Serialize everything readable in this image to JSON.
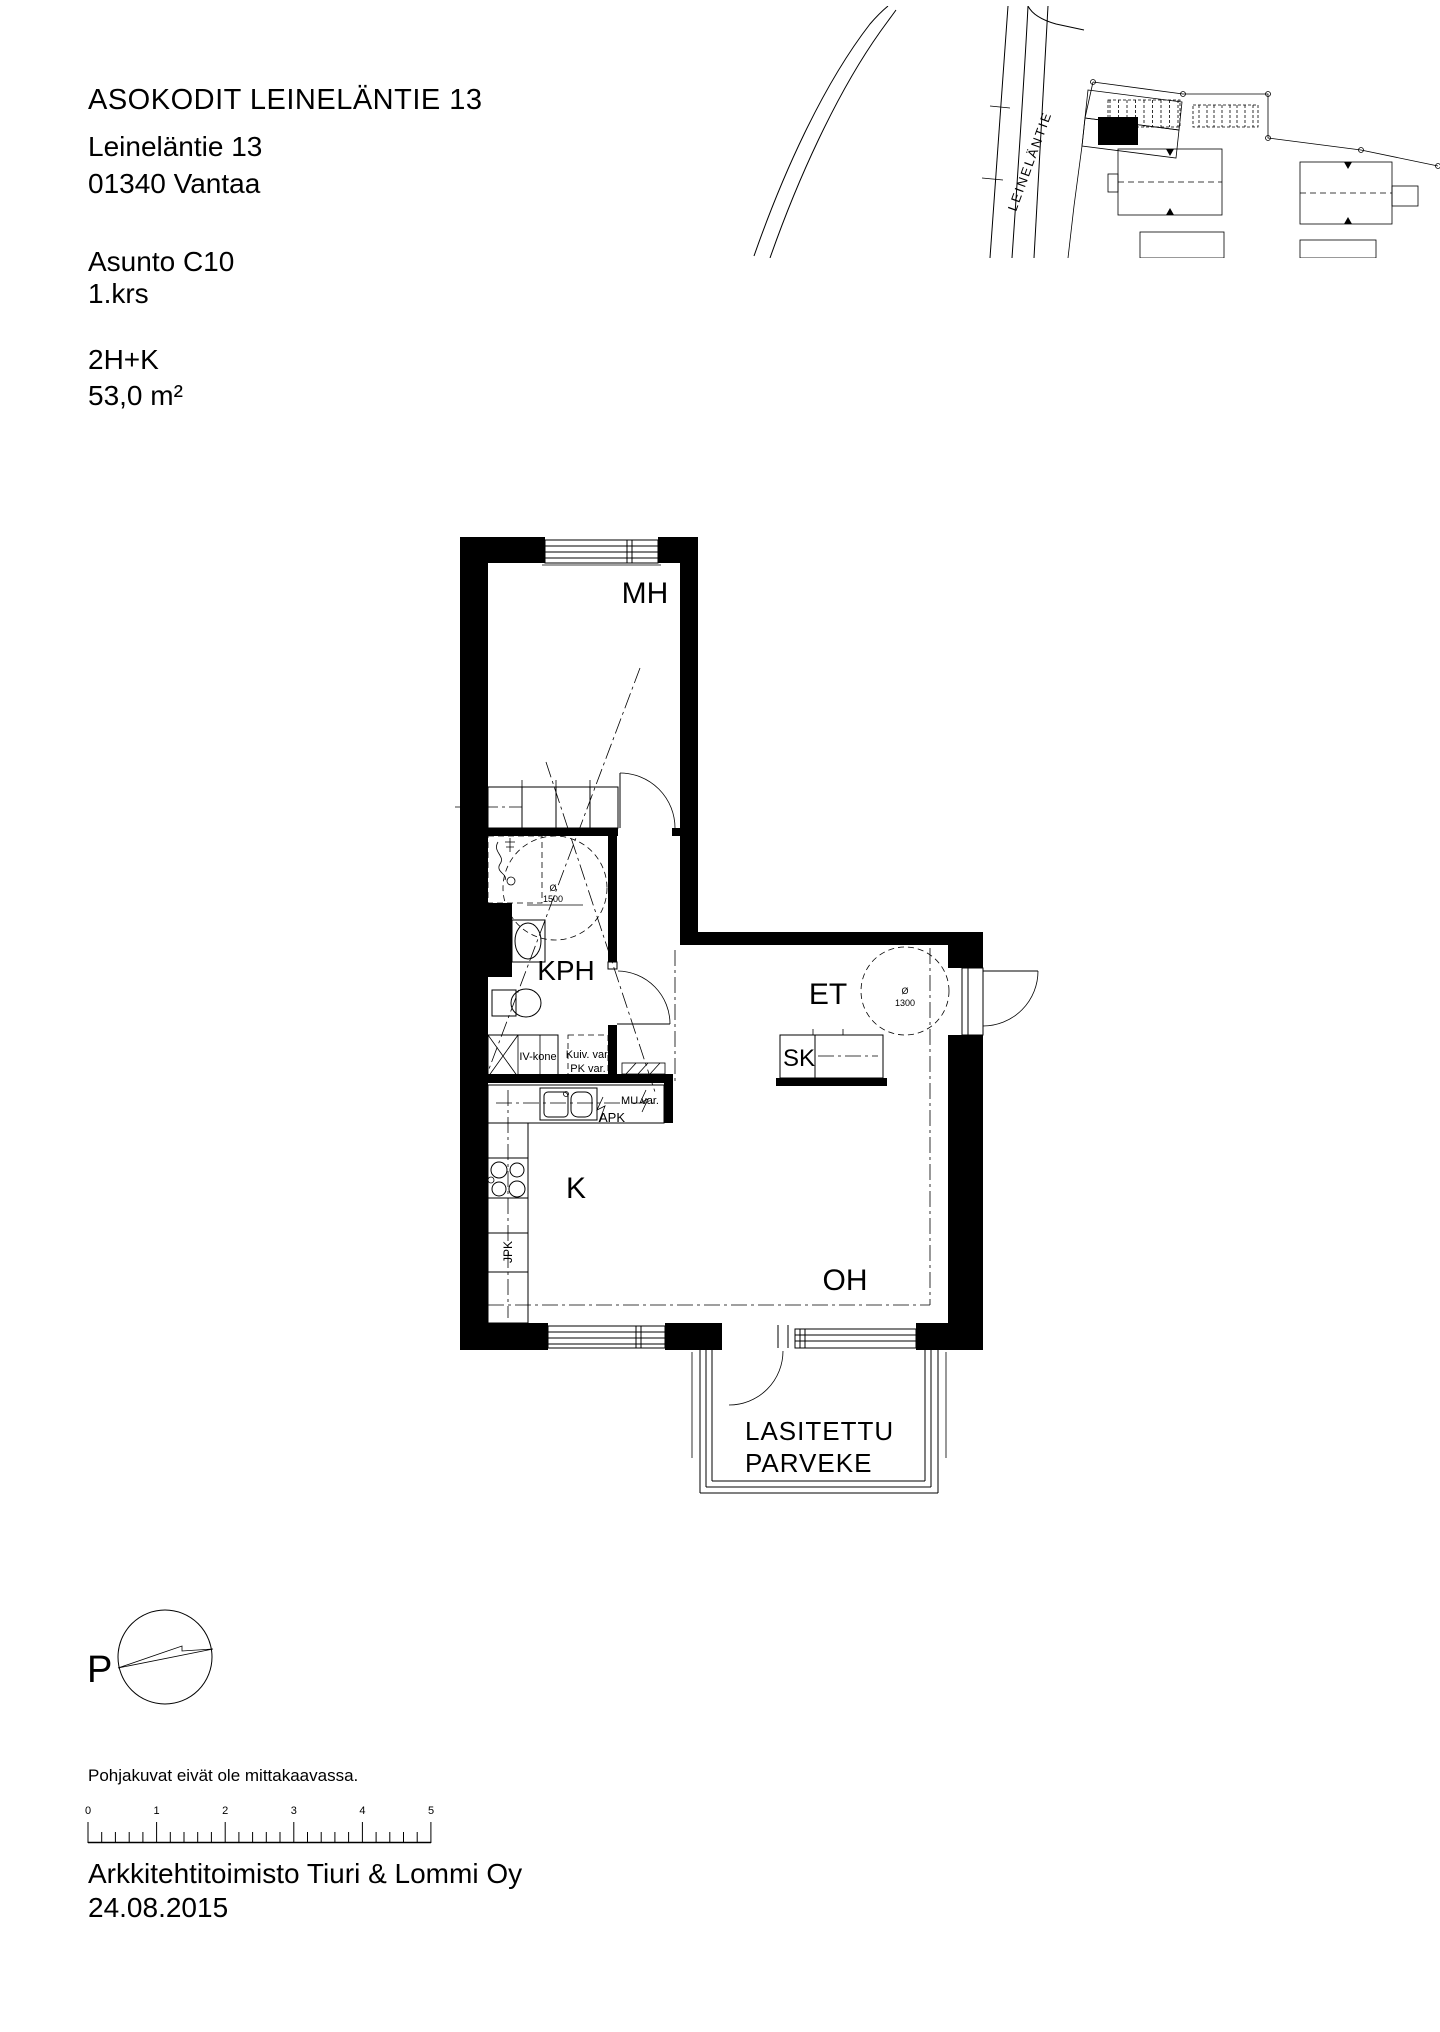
{
  "header": {
    "project": "ASOKODIT LEINELÄNTIE 13",
    "street": "Leineläntie 13",
    "city": "01340 Vantaa",
    "apartment": "Asunto C10",
    "floor": "1.krs",
    "type": "2H+K",
    "area": "53,0 m²"
  },
  "site_plan": {
    "street_label": "LEINELÄNTIE"
  },
  "plan": {
    "rooms": {
      "mh": "MH",
      "kph": "KPH",
      "et": "ET",
      "k": "K",
      "oh": "OH"
    },
    "labels": {
      "sk": "SK",
      "iv_kone": "IV-kone",
      "kuiv_var": "Kuiv. var.",
      "pk_var": "PK var.",
      "mu_var": "MU var.",
      "apk": "APK",
      "jpk": "JPK"
    },
    "circles": {
      "kph": {
        "sym": "Ø",
        "value": "1500"
      },
      "et": {
        "sym": "Ø",
        "value": "1300"
      }
    },
    "balcony": {
      "line1": "LASITETTU",
      "line2": "PARVEKE"
    }
  },
  "compass": {
    "north_label": "P"
  },
  "footer": {
    "disclaimer": "Pohjakuvat eivät ole mittakaavassa.",
    "company": "Arkkitehtitoimisto Tiuri & Lommi Oy",
    "date": "24.08.2015"
  },
  "scale_bar": {
    "ticks": [
      "0",
      "1",
      "2",
      "3",
      "4",
      "5"
    ]
  }
}
